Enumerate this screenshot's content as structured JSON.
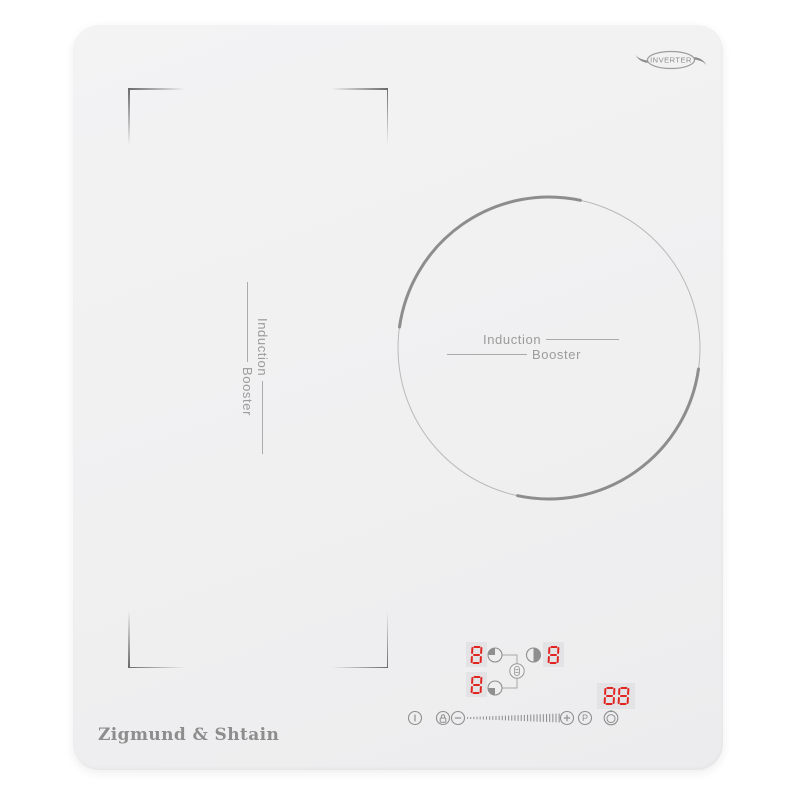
{
  "badge": {
    "label": "INVERTER"
  },
  "logo": {
    "text": "Zigmund & Shtain"
  },
  "zones": {
    "left_flex": {
      "label_primary": "Induction",
      "label_secondary": "Booster"
    },
    "right_round": {
      "label_primary": "Induction",
      "label_secondary": "Booster"
    }
  },
  "displays": {
    "rear_left_level": "8",
    "front_left_level": "8",
    "right_level": "8",
    "timer": "88"
  },
  "zone_selectors": {
    "rear_left_icon": "circle-quarter-top-left",
    "front_left_icon": "circle-quarter-bottom-left",
    "right_icon": "circle-half-right",
    "bridge_icon": "bridge-link"
  },
  "controls": {
    "power_icon": "power",
    "lock_icon": "padlock",
    "minus_icon": "minus",
    "plus_icon": "plus",
    "boost_label": "P",
    "timer_icon": "clock",
    "slider": {
      "tick_count": 30
    }
  },
  "colors": {
    "glass": "#f1f1f2",
    "segment_red": "#e02520",
    "display_bg": "#e3e3e5",
    "icon_gray": "#8f8f8f",
    "text_gray": "#9b9b9b",
    "line_gray": "#ababab",
    "bracket_gray": "#6e6e6e"
  }
}
